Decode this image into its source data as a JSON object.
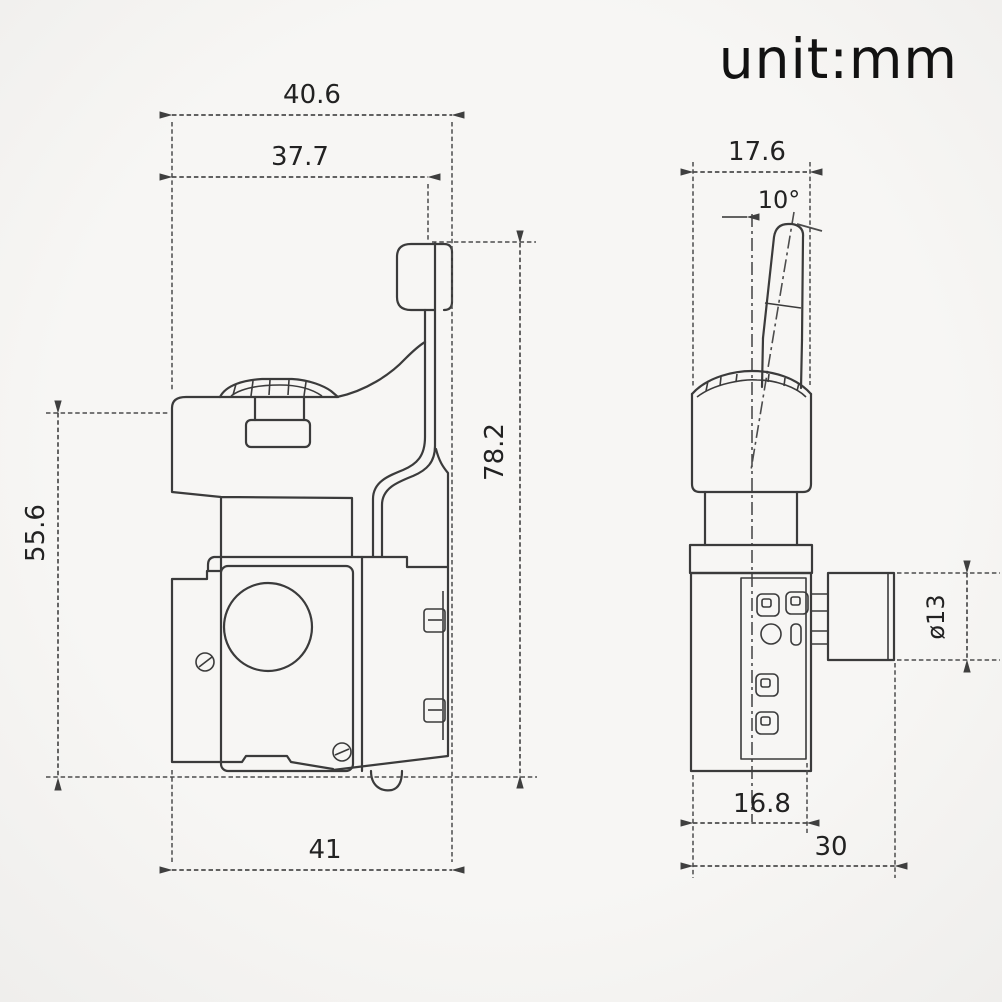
{
  "page": {
    "title": "unit:mm"
  },
  "drawing": {
    "side_view": {
      "dims": {
        "overall_width": "40.6",
        "bracket_offset": "37.7",
        "trigger_height": "55.6",
        "bracket_height": "78.2",
        "body_width": "41"
      }
    },
    "front_view": {
      "dims": {
        "head_width": "17.6",
        "lever_angle": "10°",
        "wheel_diameter": "ø13",
        "terminal_block_width": "16.8",
        "body_depth": "30"
      }
    }
  },
  "colors": {
    "background": "#f5f4f2",
    "line": "#3b3b3b",
    "dimension": "#4c4c4c",
    "text": "#222222",
    "title": "#121212"
  }
}
